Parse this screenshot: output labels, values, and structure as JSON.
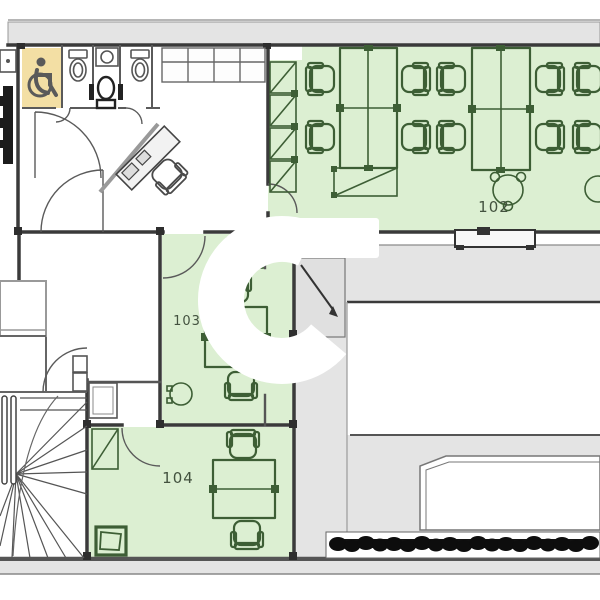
{
  "floor_plan": {
    "rooms": [
      {
        "number": "102",
        "type": "open-office"
      },
      {
        "number": "103",
        "type": "office"
      },
      {
        "number": "104",
        "type": "office"
      }
    ],
    "colors": {
      "room_green": "#dcefd2",
      "furniture_green": "#3d5e35",
      "accessible_wc_tan": "#f3dfa4",
      "wall_dark": "#3a3a3a",
      "surface_gray": "#e4e4e4",
      "fixture_gray": "#555555",
      "hedge_black": "#0d0d0d",
      "logo_white": "#ffffff",
      "label_color": "#43523f"
    },
    "icons": [
      "wheelchair-icon",
      "toilet-icon",
      "sink-icon",
      "office-chair-icon",
      "desk-icon",
      "staircase-icon",
      "hedge-icon",
      "logo-watermark-icon"
    ]
  }
}
